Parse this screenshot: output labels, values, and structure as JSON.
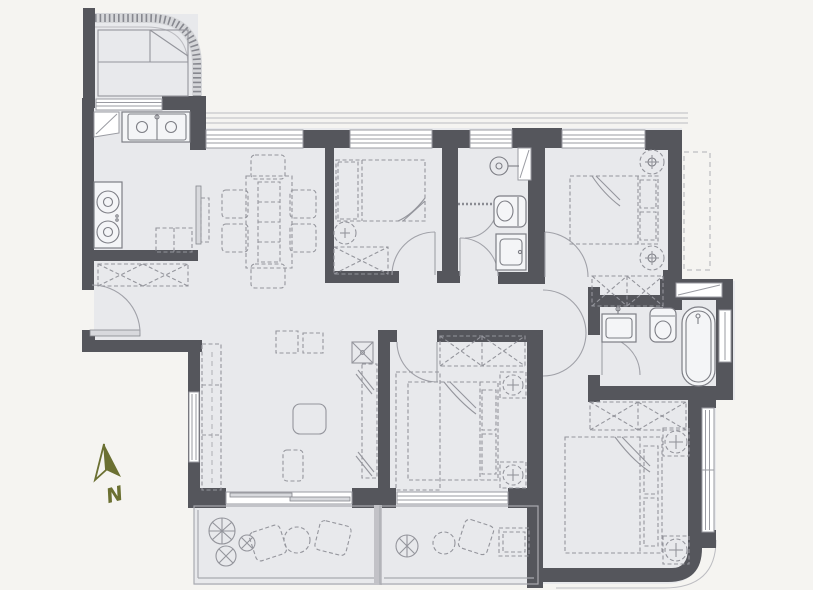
{
  "compass": {
    "label": "N"
  },
  "colors": {
    "background": "#f5f4f1",
    "room_fill": "#e8e9ec",
    "wall": "#55565c",
    "fixture_line": "#7d7e85",
    "furniture_line": "#94959c",
    "window_line": "#9a9ba2",
    "thin_line": "#bcbcc1",
    "white": "#ffffff",
    "compass_green": "#6b7032"
  }
}
